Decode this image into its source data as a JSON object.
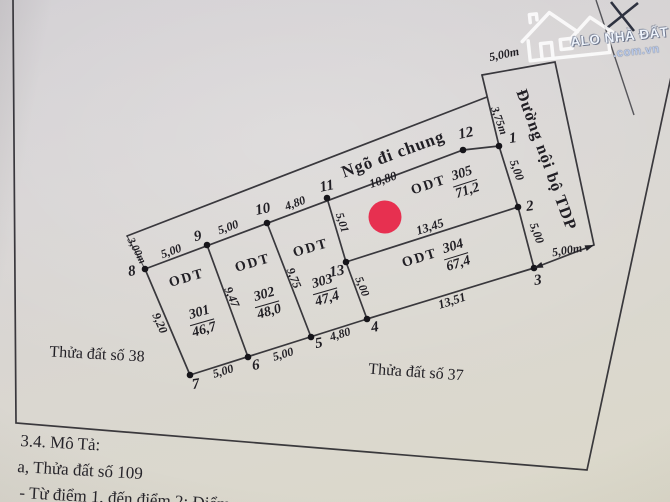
{
  "colors": {
    "paper": "#d8d5cf",
    "ink": "#232228",
    "marker_red": "#e73050",
    "watermark_text": "#eef3fb",
    "watermark_domain": "#b9c9e8"
  },
  "watermark": {
    "brand": "ALO NHÀ ĐẤT",
    "domain": ".com.vn"
  },
  "map": {
    "alley_name": "Ngõ đi chung",
    "road_name": "Đường nội bộ TDP",
    "neighbor_left": "Thửa đất số 38",
    "neighbor_bottom": "Thửa đất số 37",
    "points": {
      "p1": "1",
      "p2": "2",
      "p3": "3",
      "p4": "4",
      "p5": "5",
      "p6": "6",
      "p7": "7",
      "p8": "8",
      "p9": "9",
      "p10": "10",
      "p11": "11",
      "p12": "12",
      "p13": "13"
    },
    "plots": {
      "301": {
        "type": "ODT",
        "number": "301",
        "area": "46,7"
      },
      "302": {
        "type": "ODT",
        "number": "302",
        "area": "48,0"
      },
      "303": {
        "type": "ODT",
        "number": "303",
        "area": "47,4"
      },
      "304": {
        "type": "ODT",
        "number": "304",
        "area": "67,4"
      },
      "305": {
        "type": "ODT",
        "number": "305",
        "area": "71,2"
      }
    },
    "dims": {
      "alley_width": "3,00m",
      "seg_8_9": "5,00",
      "seg_9_10": "5,00",
      "seg_10_11": "4,80",
      "seg_11_12": "10,80",
      "seg_12_1": "3,75m",
      "seg_1_2": "5,00",
      "seg_2_3": "5,00",
      "seg_7_6": "5,00",
      "seg_6_5": "5,00",
      "seg_5_4": "4,80",
      "edge_8_7": "9,20",
      "edge_9_6": "9,47",
      "edge_10_5": "9,75",
      "edge_11_13": "5,01",
      "edge_13_4": "5,00",
      "edge_13_2": "13,45",
      "edge_4_3": "13,51",
      "road_top_width": "5,00m",
      "road_bottom_width": "5,00m"
    }
  },
  "description": {
    "heading": "3.4. Mô Tả:",
    "line_a": "a, Thửa đất số 109",
    "line_b": "- Từ điểm 1, đến điểm 2: Điểm"
  }
}
